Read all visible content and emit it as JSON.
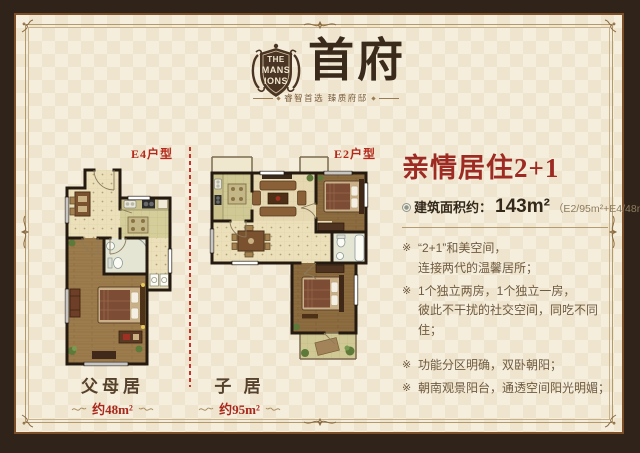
{
  "logo": {
    "crest_lines": [
      "THE",
      "MANS",
      "IONS"
    ],
    "title": "首府",
    "tagline": "睿智首选 臻质府邸"
  },
  "plans": {
    "left": {
      "type_label": "E4户型",
      "name": "父母居",
      "area": "约48m²"
    },
    "right": {
      "type_label": "E2户型",
      "name": "子 居",
      "area": "约95m²"
    }
  },
  "info": {
    "headline": "亲情居住2+1",
    "area_label": "建筑面积约：",
    "area_value": "143m²",
    "area_detail": "（E2/95m²+E4/48m²）",
    "bullets": [
      {
        "lines": [
          "“2+1”和美空间，",
          "连接两代的温馨居所；"
        ]
      },
      {
        "lines": [
          "1个独立两房，1个独立一房，",
          "彼此不干扰的社交空间，同吃不同住；"
        ]
      },
      {
        "lines": [
          "功能分区明确，双卧朝阳；"
        ]
      },
      {
        "lines": [
          "朝南观景阳台，通透空间阳光明媚；"
        ]
      }
    ]
  },
  "icons": {
    "bullet_marker": "※"
  },
  "colors": {
    "frame_dark": "#30241a",
    "frame_line": "#7d4f28",
    "canvas_cream": "#f5eedc",
    "accent_red": "#9e2b23",
    "label_red": "#b5291d",
    "text_brown": "#6e5a40",
    "caption_brown": "#56422c"
  }
}
